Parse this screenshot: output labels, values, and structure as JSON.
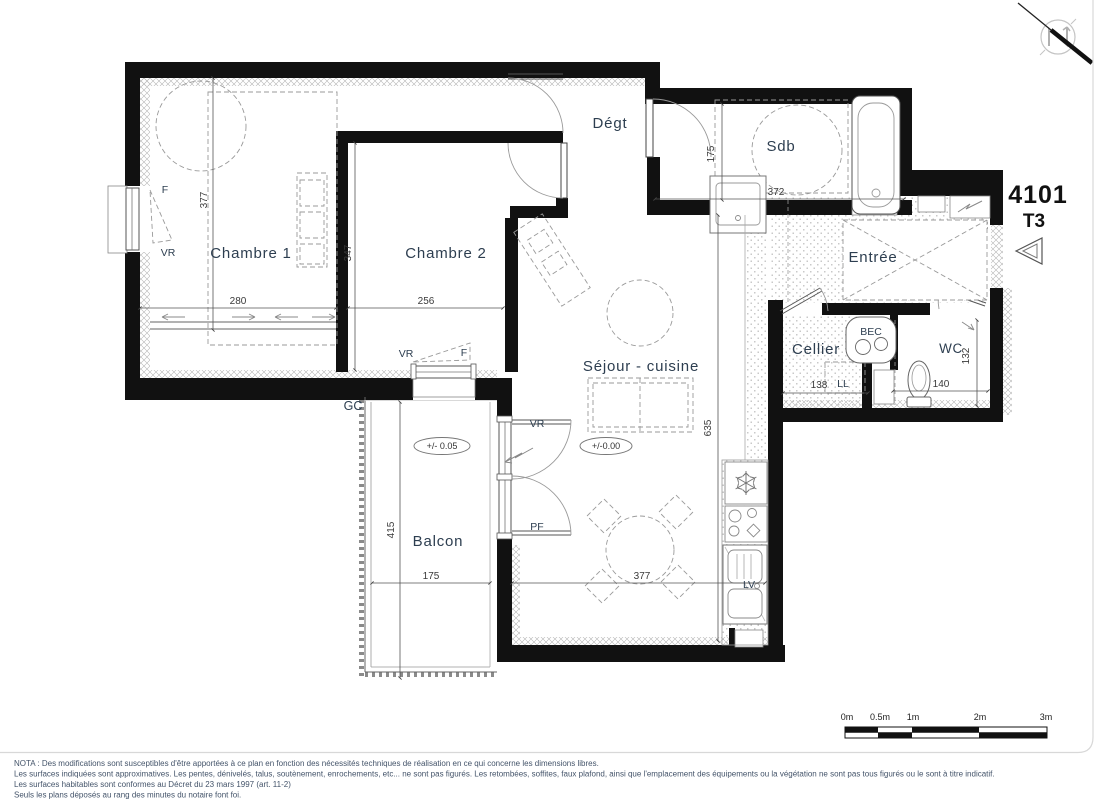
{
  "header": {
    "unit_number": "4101",
    "unit_type": "T3"
  },
  "rooms": {
    "chambre1": "Chambre 1",
    "chambre2": "Chambre 2",
    "degt": "Dégt",
    "sdb": "Sdb",
    "entree": "Entrée",
    "cellier": "Cellier",
    "wc": "WC",
    "sejour": "Séjour - cuisine",
    "balcon": "Balcon"
  },
  "dims": {
    "ch1_h": "377",
    "ch1_w": "280",
    "ch2_h": "347",
    "ch2_w": "256",
    "sdb_h": "175",
    "sdb_w": "372",
    "sejour_h": "635",
    "sejour_w": "377",
    "balcon_w": "175",
    "balcon_h": "415",
    "cellier_w": "138",
    "wc_w": "140",
    "wc_h": "132"
  },
  "labels": {
    "f_ch1": "F",
    "vr_ch1": "VR",
    "vr_ch2": "VR",
    "f_ch2": "F",
    "gc": "GC",
    "vr_sejour": "VR",
    "pf": "PF",
    "lv": "LV",
    "ll": "LL",
    "bec": "BEC"
  },
  "levels": {
    "balcon": "+/- 0.05",
    "sejour": "+/-0.00"
  },
  "scalebar": {
    "l0": "0m",
    "l1": "0.5m",
    "l2": "1m",
    "l3": "2m",
    "l4": "3m"
  },
  "notes": {
    "line1": "NOTA : Des modifications sont susceptibles d'être apportées à ce plan en fonction des nécessités techniques de réalisation en ce qui concerne les dimensions libres.",
    "line2": "Les surfaces indiquées sont approximatives. Les pentes, dénivelés, talus, soutènement, enrochements, etc... ne sont pas figurés. Les retombées, soffites, faux plafond, ainsi que l'emplacement des équipements ou la végétation ne sont pas tous figurés ou le sont à titre indicatif.",
    "line3": "Les surfaces habitables sont conformes au Décret du 23 mars 1997 (art. 11-2)",
    "line4": "Seuls les plans déposés au rang des minutes du notaire font foi."
  },
  "colors": {
    "wall": "#111111",
    "room_label": "#2d3e50",
    "dimension_text": "#3a3a3a",
    "note_text": "#44546a",
    "hatch": "#b5b5b5",
    "floor_dots": "#c9c9c9"
  }
}
